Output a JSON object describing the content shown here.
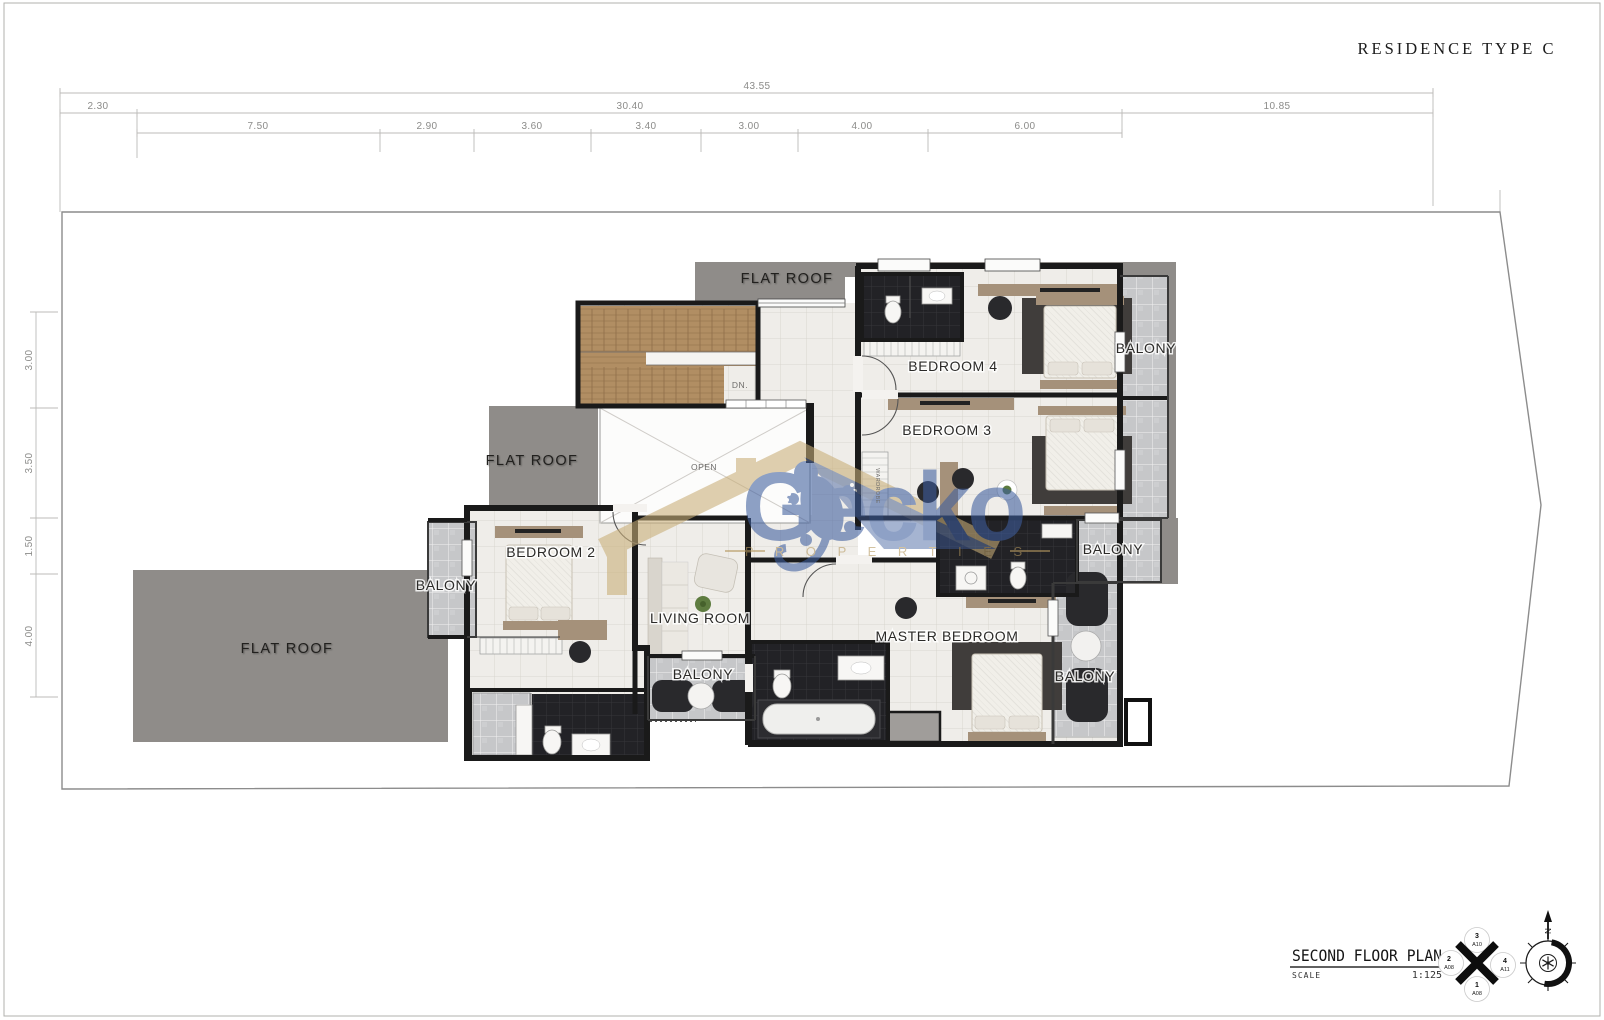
{
  "page": {
    "title": "RESIDENCE  TYPE  C"
  },
  "dimensions": {
    "top_total": "43.55",
    "row2": [
      "2.30",
      "30.40",
      "10.85"
    ],
    "row3": [
      "7.50",
      "2.90",
      "3.60",
      "3.40",
      "3.00",
      "4.00",
      "6.00"
    ],
    "left": [
      "3.00",
      "3.50",
      "1.50",
      "4.00"
    ]
  },
  "labels": {
    "flat_roof": "FLAT ROOF",
    "bedroom4": "BEDROOM 4",
    "bedroom3": "BEDROOM 3",
    "bedroom2": "BEDROOM 2",
    "master_bedroom": "MASTER BEDROOM",
    "living_room": "LIVING ROOM",
    "balcony": "BALONY",
    "open": "OPEN",
    "down": "DN.",
    "wardrobe": "WARDROBE"
  },
  "watermark": {
    "brand": "Gecko",
    "subtitle": "P R O P E R T I E S"
  },
  "title_block": {
    "plan_name": "SECOND FLOOR PLAN",
    "scale_label": "SCALE",
    "scale_value": "1:125"
  },
  "section_marker": {
    "top_num": "3",
    "top_ref": "A10",
    "left_num": "2",
    "left_ref": "A08",
    "right_num": "4",
    "right_ref": "A11",
    "bottom_num": "1",
    "bottom_ref": "A08"
  },
  "compass": {
    "north": "N"
  },
  "colors": {
    "wall": "#1a1a1a",
    "roof-gray": "#8f8c89",
    "tile-gray": "#c6c7c9",
    "floor": "#efede9",
    "bath-dark": "#232327",
    "wood": "#b18e63",
    "wm-blue": "#3e5e9e",
    "wm-gold": "#c3a873",
    "accent-tan": "#a5917a",
    "rug-dark": "#403d3b"
  }
}
